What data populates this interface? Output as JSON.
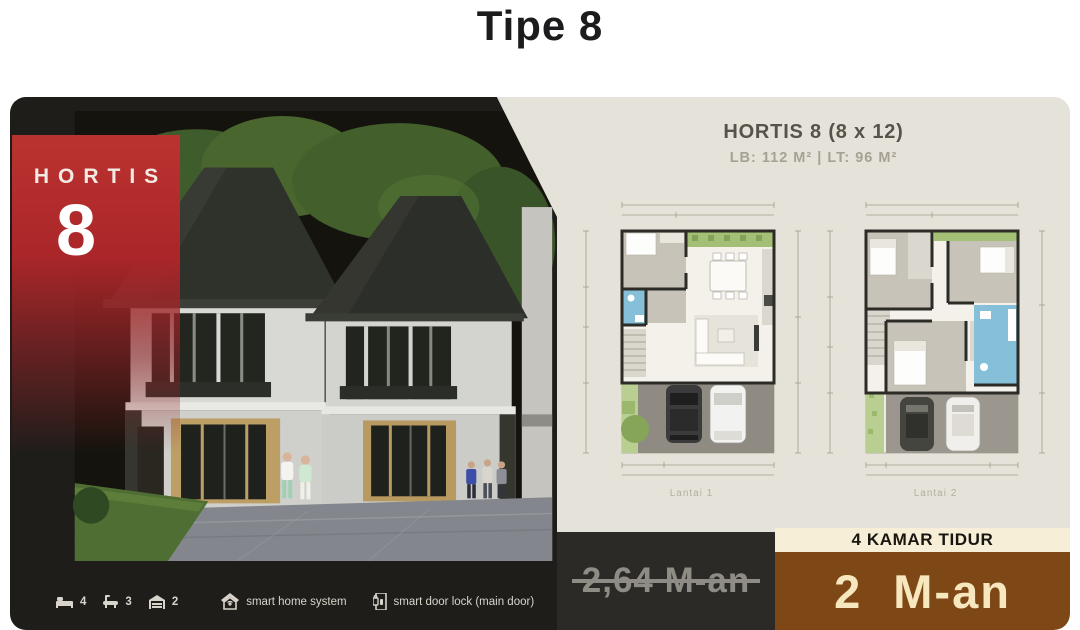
{
  "page": {
    "title": "Tipe 8"
  },
  "colors": {
    "accent_red": "#b5272b",
    "panel_dark": "#1f1d1a",
    "beige": "#e5e2d9",
    "cream": "#f6eed6",
    "brown": "#7d4716"
  },
  "left_panel": {
    "ribbon": {
      "brand": "HORTIS",
      "number": "8"
    },
    "features": [
      {
        "icon": "bed-icon",
        "count": "4"
      },
      {
        "icon": "bath-icon",
        "count": "3"
      },
      {
        "icon": "garage-icon",
        "count": "2"
      }
    ],
    "smart": [
      {
        "icon": "smart-home-icon",
        "label": "smart home system"
      },
      {
        "icon": "door-lock-icon",
        "label": "smart door lock (main door)"
      }
    ]
  },
  "right_panel": {
    "title": "HORTIS 8 (8 x 12)",
    "specs": "LB: 112 M²  |  LT: 96 M²",
    "floorplans": [
      {
        "label": "Lantai 1"
      },
      {
        "label": "Lantai 2"
      }
    ],
    "bedrooms": "4 KAMAR TIDUR",
    "price_old": "2,64 M-an",
    "price_new": "2 M-an"
  }
}
